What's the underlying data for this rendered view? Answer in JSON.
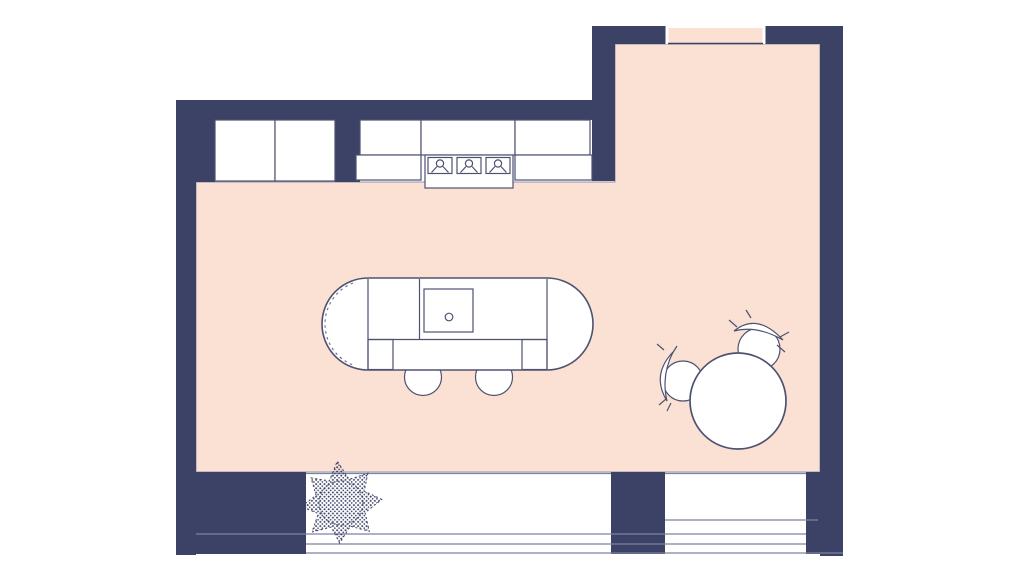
{
  "meta": {
    "type": "floor-plan",
    "view": "top-down",
    "rooms": [
      "kitchen",
      "dining-area",
      "balcony-window-strip"
    ]
  },
  "colors": {
    "background": "#ffffff",
    "wall": "#3c4166",
    "floor": "#fbe1d3",
    "floorEdge": "#9094ac",
    "furniture": "#ffffff",
    "line": "#4e5270",
    "softline": "#7d82a0"
  },
  "objects": {
    "counters": "upper and lower kitchen cabinets along top wall",
    "cooktop": "3-burner cooktop in lower counter run",
    "island": "stadium-shaped kitchen island with sink, faucet, seating ledge and two stools",
    "dining": "round dining table with two chairs with curved backs",
    "plant": "stippled potted plant on balcony strip",
    "openings": "doorway opening in top wall of dining area; window band along bottom wall"
  }
}
